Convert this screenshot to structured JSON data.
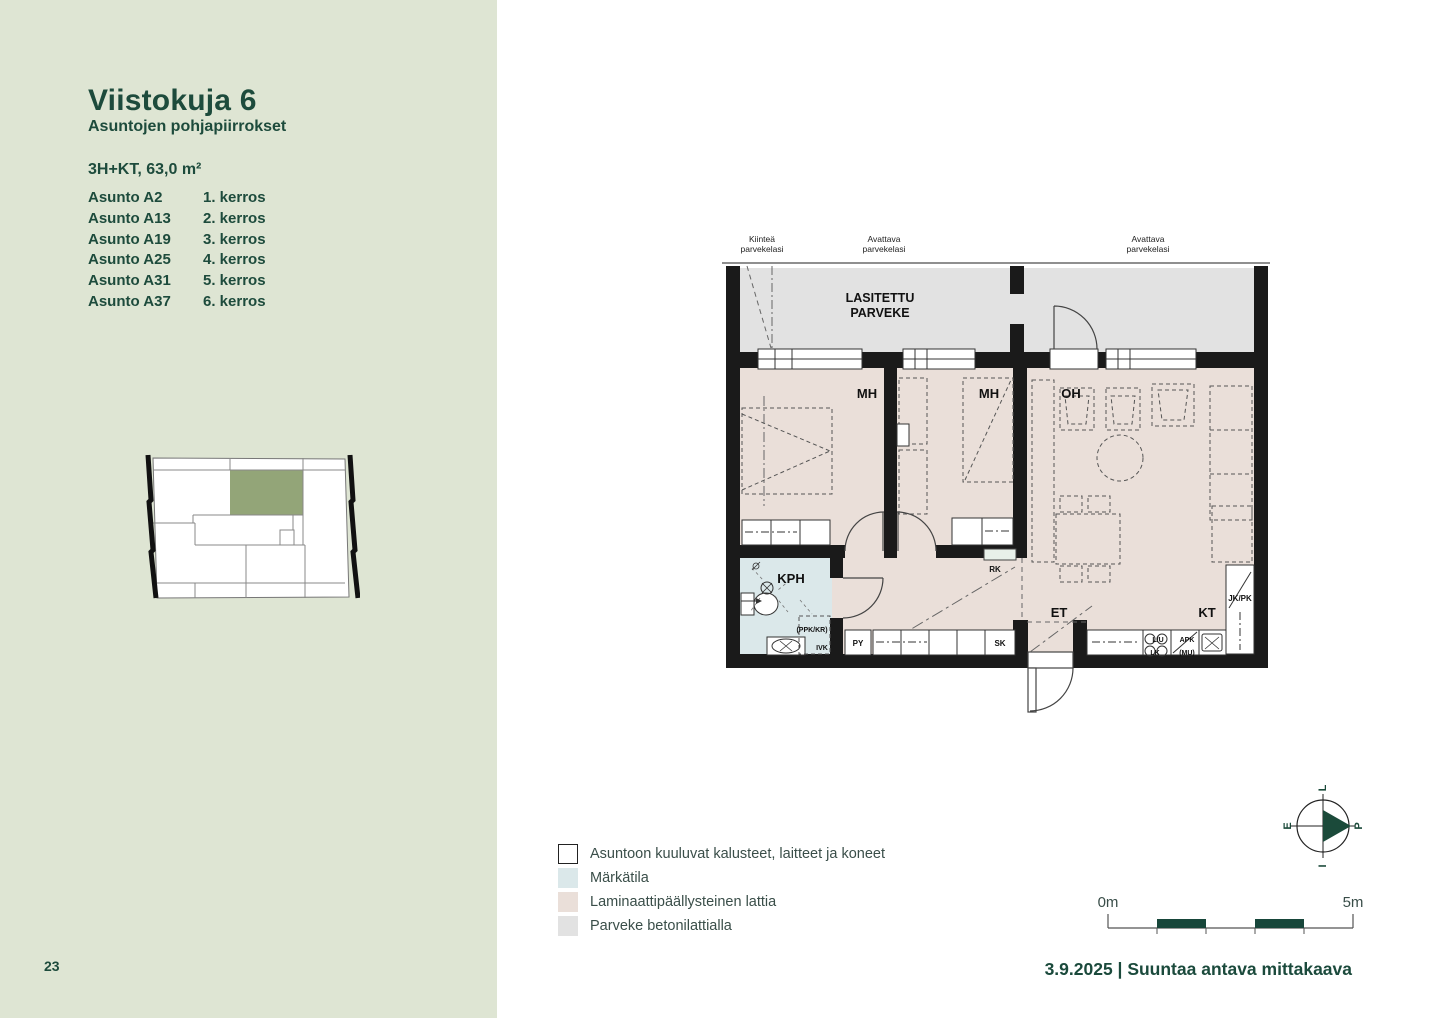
{
  "page": {
    "number": "23"
  },
  "sidebar": {
    "title": "Viistokuja 6",
    "subtitle": "Asuntojen pohjapiirrokset",
    "apartment_type": "3H+KT, 63,0 m²",
    "apartments": [
      {
        "name": "Asunto A2",
        "floor": "1. kerros"
      },
      {
        "name": "Asunto A13",
        "floor": "2. kerros"
      },
      {
        "name": "Asunto A19",
        "floor": "3. kerros"
      },
      {
        "name": "Asunto A25",
        "floor": "4. kerros"
      },
      {
        "name": "Asunto A31",
        "floor": "5. kerros"
      },
      {
        "name": "Asunto A37",
        "floor": "6. kerros"
      }
    ]
  },
  "plan": {
    "glass_labels": [
      {
        "l1": "Kiinteä",
        "l2": "parvekelasi"
      },
      {
        "l1": "Avattava",
        "l2": "parvekelasi"
      },
      {
        "l1": "Avattava",
        "l2": "parvekelasi"
      }
    ],
    "balcony": {
      "l1": "LASITETTU",
      "l2": "PARVEKE"
    },
    "rooms": {
      "bedroom1": "MH",
      "bedroom2": "MH",
      "living": "OH",
      "bathroom": "KPH",
      "entry": "ET",
      "kitchen": "KT"
    },
    "marks": {
      "ppk_kr": "(PPK/KR)",
      "ivk": "IVK",
      "py": "PY",
      "sk": "SK",
      "rk": "RK",
      "jk_pk": "JK/PK",
      "l_u": "L/U",
      "lk": "LK",
      "apk": "APK",
      "mu": "(MU)"
    }
  },
  "legend": {
    "items": [
      {
        "label": "Asuntoon kuuluvat kalusteet, laitteet ja koneet",
        "swatch": "#ffffff"
      },
      {
        "label": "Märkätila",
        "swatch": "#dbe8ea"
      },
      {
        "label": "Laminaattipäällysteinen lattia",
        "swatch": "#eadfd9"
      },
      {
        "label": "Parveke betonilattialla",
        "swatch": "#e2e2e2"
      }
    ]
  },
  "compass": {
    "right": "P",
    "top": "L",
    "left": "E",
    "bottom": "I"
  },
  "scalebar": {
    "zero": "0m",
    "five": "5m"
  },
  "footer": {
    "text": "3.9.2025 | Suuntaa antava mittakaava"
  },
  "colors": {
    "sidebar_bg": "#dee5d3",
    "brand_green": "#1d4b3c",
    "keyplan_highlight": "#93a578",
    "floor_laminate": "#eadfd9",
    "wet_room": "#dbe8ea",
    "balcony_concrete": "#e2e2e2",
    "wall": "#1a1a1a",
    "scale_green": "#17463a"
  }
}
